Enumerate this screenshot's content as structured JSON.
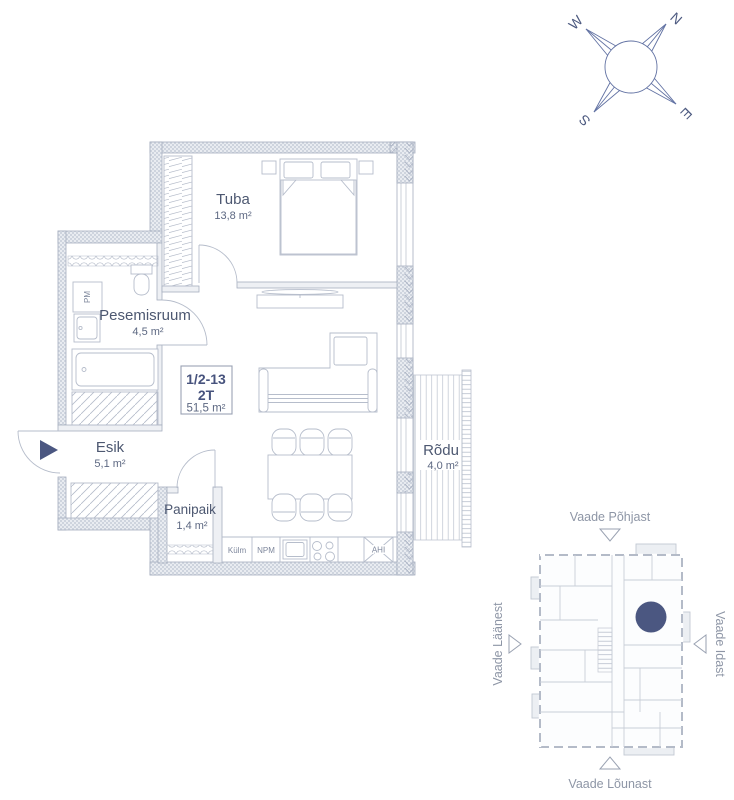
{
  "compass": {
    "north": "N",
    "east": "E",
    "south": "S",
    "west": "W"
  },
  "floorplan": {
    "rooms": [
      {
        "name": "Tuba",
        "area": "13,8 m²"
      },
      {
        "name": "Pesemisruum",
        "area": "4,5 m²"
      },
      {
        "name": "Esik",
        "area": "5,1 m²"
      },
      {
        "name": "Panipaik",
        "area": "1,4 m²"
      },
      {
        "name": "Rõdu",
        "area": "4,0 m²"
      }
    ],
    "unit": {
      "number": "1/2-13",
      "type": "2T",
      "area": "51,5 m²"
    },
    "appliances": {
      "fridge": "Külm",
      "dishwasher": "NPM",
      "oven": "AHI",
      "washer": "PM"
    }
  },
  "minimap": {
    "view_north": "Vaade Põhjast",
    "view_west": "Vaade Läänest",
    "view_east": "Vaade Idast",
    "view_south": "Vaade Lõunast"
  },
  "colors": {
    "accent": "#4b5781",
    "line": "#b6bdcb",
    "text": "#4d5871",
    "muted": "#8e96a6"
  }
}
